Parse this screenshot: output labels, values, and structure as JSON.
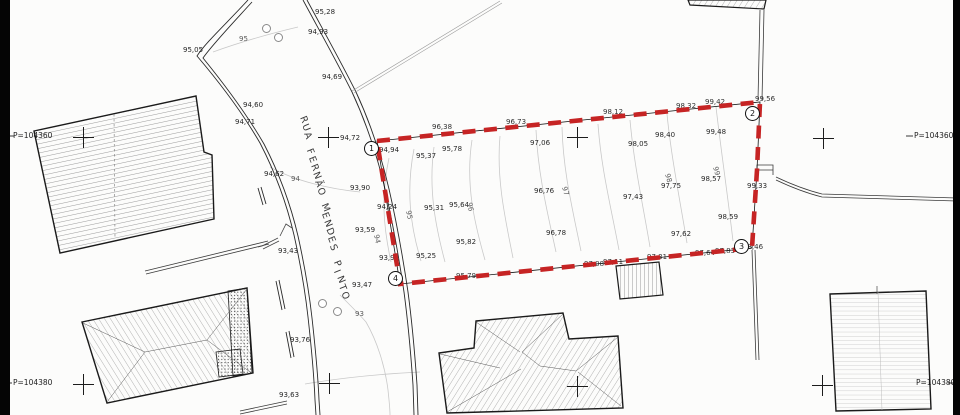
{
  "plan": {
    "street_name": "RUA FERNÃO MENDES PINTO",
    "colors": {
      "boundary_red": "#c62424",
      "contour_gray": "#c9c9c9"
    },
    "frame_labels": [
      {
        "t": "P=104360",
        "x": 13,
        "y": 132
      },
      {
        "t": "P=104380",
        "x": 13,
        "y": 379
      },
      {
        "t": "P=104360",
        "x": 914,
        "y": 132
      },
      {
        "t": "P=104380",
        "x": 916,
        "y": 379
      }
    ],
    "vertex_markers": [
      {
        "label": "1",
        "x": 371,
        "y": 148
      },
      {
        "label": "2",
        "x": 752,
        "y": 113
      },
      {
        "label": "3",
        "x": 741,
        "y": 246
      },
      {
        "label": "4",
        "x": 395,
        "y": 278
      }
    ],
    "contour_labels": [
      {
        "t": "95",
        "x": 239,
        "y": 36
      },
      {
        "t": "94",
        "x": 291,
        "y": 176
      },
      {
        "t": "93",
        "x": 355,
        "y": 311
      },
      {
        "t": "94",
        "x": 379,
        "y": 234,
        "r": 78
      },
      {
        "t": "95",
        "x": 411,
        "y": 210,
        "r": 78
      },
      {
        "t": "96",
        "x": 472,
        "y": 202,
        "r": 78
      },
      {
        "t": "97",
        "x": 567,
        "y": 186,
        "r": 75
      },
      {
        "t": "98",
        "x": 670,
        "y": 173,
        "r": 75
      },
      {
        "t": "99",
        "x": 718,
        "y": 166,
        "r": 75
      }
    ],
    "spot_elevations": [
      {
        "t": "95,05",
        "x": 183,
        "y": 47
      },
      {
        "t": "95,28",
        "x": 315,
        "y": 9
      },
      {
        "t": "94,93",
        "x": 308,
        "y": 29
      },
      {
        "t": "94,69",
        "x": 322,
        "y": 74
      },
      {
        "t": "94,60",
        "x": 243,
        "y": 102
      },
      {
        "t": "94,71",
        "x": 235,
        "y": 119
      },
      {
        "t": "94,62",
        "x": 264,
        "y": 171
      },
      {
        "t": "94,72",
        "x": 340,
        "y": 135
      },
      {
        "t": "93,90",
        "x": 350,
        "y": 185
      },
      {
        "t": "93,59",
        "x": 355,
        "y": 227
      },
      {
        "t": "93,43",
        "x": 278,
        "y": 248
      },
      {
        "t": "93,47",
        "x": 352,
        "y": 282
      },
      {
        "t": "93,76",
        "x": 290,
        "y": 337
      },
      {
        "t": "93,63",
        "x": 279,
        "y": 392
      },
      {
        "t": "94,94",
        "x": 379,
        "y": 147
      },
      {
        "t": "95,37",
        "x": 416,
        "y": 153
      },
      {
        "t": "95,78",
        "x": 442,
        "y": 146
      },
      {
        "t": "97,06",
        "x": 530,
        "y": 140
      },
      {
        "t": "98,05",
        "x": 628,
        "y": 141
      },
      {
        "t": "98,40",
        "x": 655,
        "y": 132
      },
      {
        "t": "99,48",
        "x": 706,
        "y": 129
      },
      {
        "t": "98,57",
        "x": 701,
        "y": 176
      },
      {
        "t": "97,75",
        "x": 661,
        "y": 183
      },
      {
        "t": "97,43",
        "x": 623,
        "y": 194
      },
      {
        "t": "97,62",
        "x": 671,
        "y": 231
      },
      {
        "t": "98,59",
        "x": 718,
        "y": 214
      },
      {
        "t": "99,33",
        "x": 747,
        "y": 183
      },
      {
        "t": "96,76",
        "x": 534,
        "y": 188
      },
      {
        "t": "96,78",
        "x": 546,
        "y": 230
      },
      {
        "t": "95,64",
        "x": 449,
        "y": 202
      },
      {
        "t": "95,31",
        "x": 424,
        "y": 205
      },
      {
        "t": "95,82",
        "x": 456,
        "y": 239
      },
      {
        "t": "95,25",
        "x": 416,
        "y": 253
      },
      {
        "t": "94,24",
        "x": 377,
        "y": 204
      },
      {
        "t": "93,92",
        "x": 379,
        "y": 255
      }
    ],
    "edge_elevations": [
      {
        "t": "96,38",
        "x": 432,
        "y": 124
      },
      {
        "t": "96,73",
        "x": 506,
        "y": 119
      },
      {
        "t": "98,12",
        "x": 603,
        "y": 109
      },
      {
        "t": "98,32",
        "x": 676,
        "y": 103
      },
      {
        "t": "99,42",
        "x": 705,
        "y": 99
      },
      {
        "t": "99,56",
        "x": 755,
        "y": 96
      },
      {
        "t": "95,79",
        "x": 456,
        "y": 273
      },
      {
        "t": "97,08",
        "x": 584,
        "y": 261
      },
      {
        "t": "97,11",
        "x": 603,
        "y": 259
      },
      {
        "t": "97,31",
        "x": 647,
        "y": 254
      },
      {
        "t": "97,64",
        "x": 695,
        "y": 250
      },
      {
        "t": "97,83",
        "x": 715,
        "y": 248
      },
      {
        "t": "98,46",
        "x": 743,
        "y": 244
      }
    ],
    "grid_crosses": [
      {
        "x": 83,
        "y": 137
      },
      {
        "x": 328,
        "y": 137
      },
      {
        "x": 577,
        "y": 137
      },
      {
        "x": 823,
        "y": 138
      },
      {
        "x": 83,
        "y": 384
      },
      {
        "x": 329,
        "y": 383
      },
      {
        "x": 577,
        "y": 386
      },
      {
        "x": 822,
        "y": 385
      }
    ],
    "trees": [
      {
        "x": 266,
        "y": 28
      },
      {
        "x": 278,
        "y": 37
      },
      {
        "x": 322,
        "y": 303
      },
      {
        "x": 337,
        "y": 311
      }
    ]
  }
}
